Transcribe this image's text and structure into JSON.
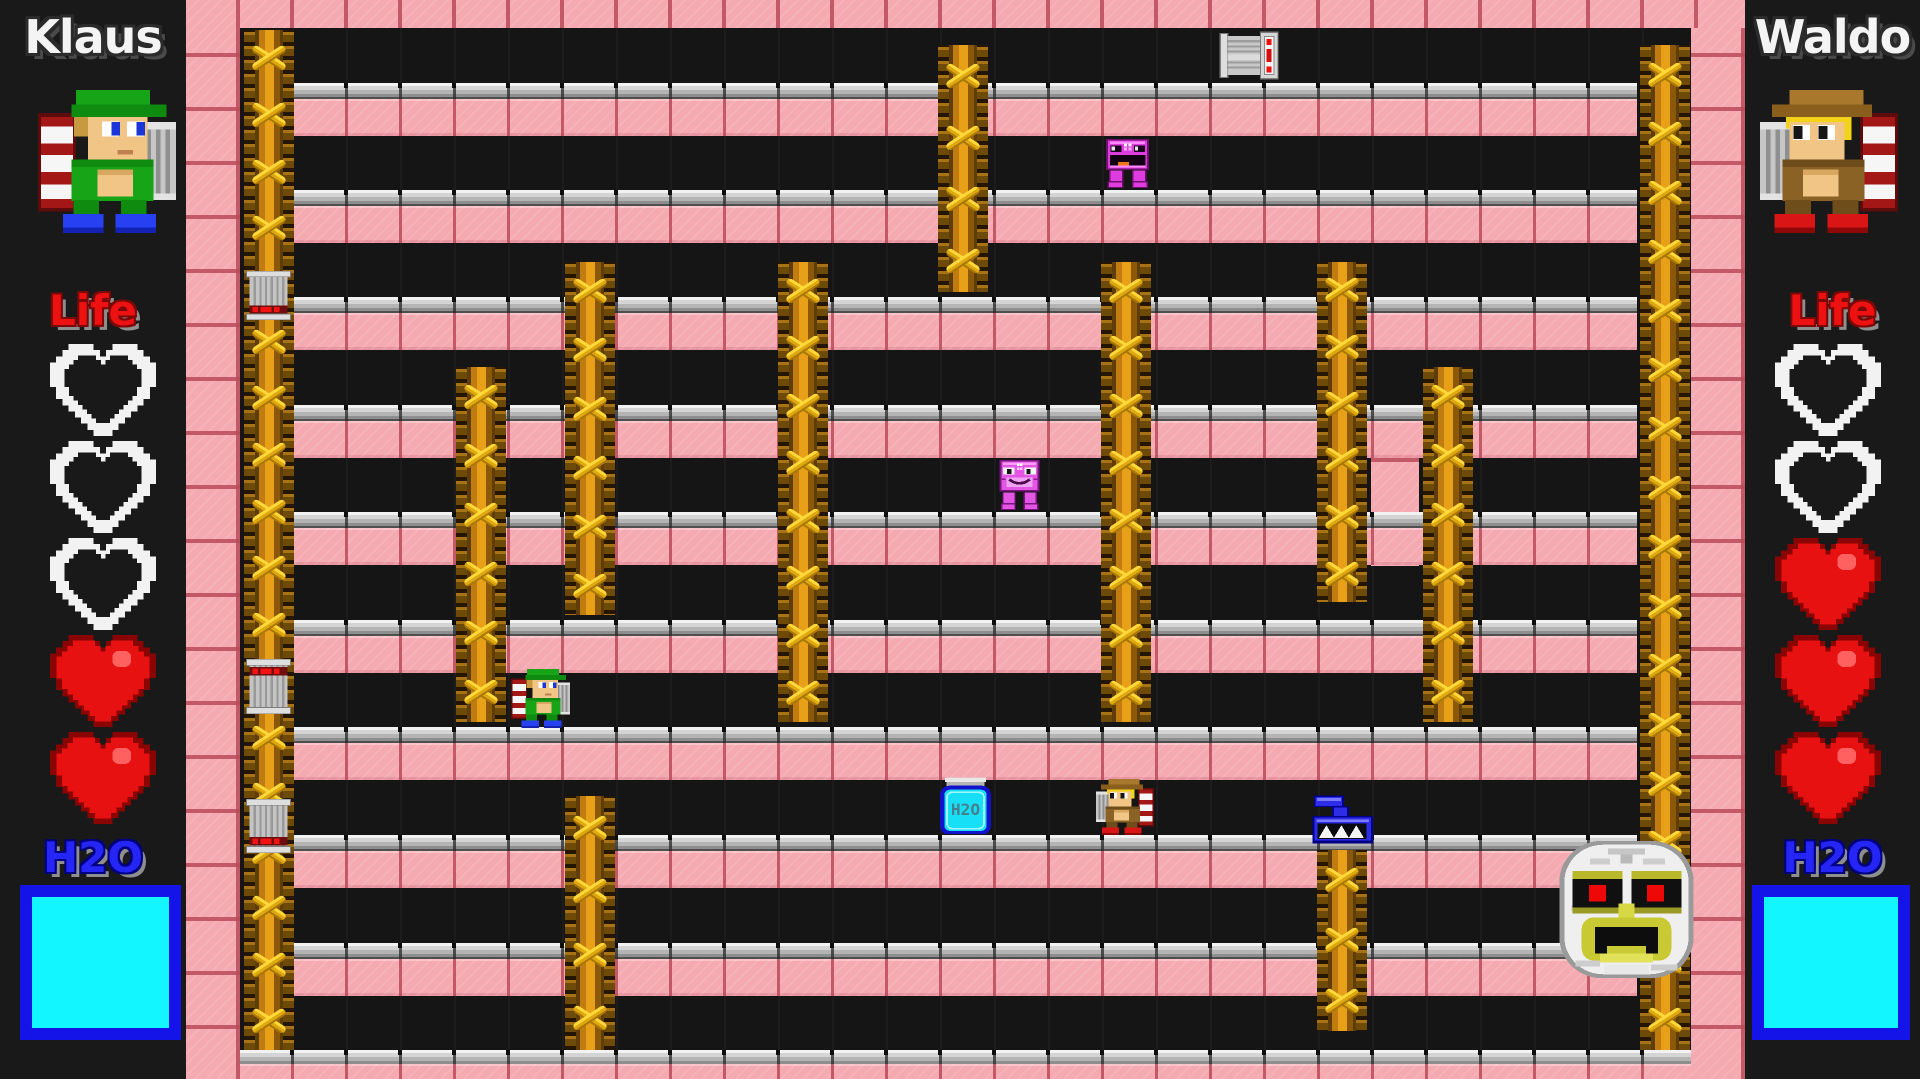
{
  "left_panel": {
    "name": "Klaus",
    "life_label": "Life",
    "h2o_label": "H2O",
    "hearts": [
      "empty",
      "empty",
      "empty",
      "full",
      "full"
    ],
    "water_percent": 100
  },
  "right_panel": {
    "name": "Waldo",
    "life_label": "Life",
    "h2o_label": "H2O",
    "hearts": [
      "empty",
      "empty",
      "full",
      "full",
      "full"
    ],
    "water_percent": 100
  },
  "items": {
    "bottle_label": "H2O"
  },
  "colors": {
    "brick": "#f5a9b1",
    "brick_seam": "#ba4a5a",
    "corridor": "#151515",
    "platform_gray": "#b4b4b4",
    "ladder_gold": "#e8a018",
    "rung_yellow": "#ffd83a",
    "heart_red": "#e81111",
    "life_red": "#ee1111",
    "h2o_blue": "#2525f5",
    "meter_border": "#1414e8",
    "water_cyan": "#12f6ff",
    "enemy_magenta": "#df3cdf",
    "tank_blue": "#2d2de8",
    "mummy_white": "#efefef"
  },
  "level": {
    "walls": [
      {
        "x": 186,
        "y": 0,
        "w": 54,
        "h": 1079
      },
      {
        "x": 1691,
        "y": 0,
        "w": 54,
        "h": 1079
      },
      {
        "x": 186,
        "y": 0,
        "w": 1559,
        "h": 28
      },
      {
        "x": 1371,
        "y": 405,
        "w": 48,
        "h": 161,
        "cap": true
      }
    ],
    "floors": [
      {
        "x": 294,
        "y": 83,
        "w": 1343
      },
      {
        "x": 294,
        "y": 190,
        "w": 1343
      },
      {
        "x": 294,
        "y": 297,
        "w": 1343
      },
      {
        "x": 294,
        "y": 405,
        "w": 1343
      },
      {
        "x": 294,
        "y": 512,
        "w": 1343
      },
      {
        "x": 294,
        "y": 620,
        "w": 1343
      },
      {
        "x": 294,
        "y": 727,
        "w": 1343
      },
      {
        "x": 294,
        "y": 835,
        "w": 1343
      },
      {
        "x": 294,
        "y": 943,
        "w": 1343
      },
      {
        "x": 240,
        "y": 1050,
        "w": 1451,
        "grayH": 14,
        "pinkH": 15
      }
    ],
    "ladders": [
      {
        "x": 244,
        "y": 30,
        "h": 1020
      },
      {
        "x": 456,
        "y": 367,
        "h": 355
      },
      {
        "x": 565,
        "y": 262,
        "h": 353
      },
      {
        "x": 565,
        "y": 796,
        "h": 254
      },
      {
        "x": 778,
        "y": 262,
        "h": 460
      },
      {
        "x": 938,
        "y": 45,
        "h": 247
      },
      {
        "x": 1101,
        "y": 262,
        "h": 460
      },
      {
        "x": 1317,
        "y": 262,
        "h": 340
      },
      {
        "x": 1317,
        "y": 850,
        "h": 181
      },
      {
        "x": 1423,
        "y": 367,
        "h": 355
      },
      {
        "x": 1640,
        "y": 45,
        "h": 1005
      }
    ],
    "sprites": [
      {
        "type": "bucket-h",
        "name": "drum-item",
        "x": 1219,
        "y": 31,
        "w": 62,
        "h": 49
      },
      {
        "type": "bucket-v",
        "variant": "bottom",
        "name": "bucket-item",
        "x": 243,
        "y": 271,
        "w": 51,
        "h": 49
      },
      {
        "type": "bucket-v",
        "variant": "top",
        "name": "bucket-item",
        "x": 243,
        "y": 659,
        "w": 51,
        "h": 55
      },
      {
        "type": "bucket-v",
        "variant": "bottom",
        "name": "bucket-item",
        "x": 243,
        "y": 799,
        "w": 51,
        "h": 54
      },
      {
        "type": "robot-mouth",
        "name": "enemy-robot-tongue",
        "x": 1098,
        "y": 133,
        "w": 59,
        "h": 58
      },
      {
        "type": "robot-cat",
        "name": "enemy-robot-cat",
        "x": 992,
        "y": 454,
        "w": 55,
        "h": 59
      },
      {
        "type": "klaus-small",
        "name": "player-klaus-field",
        "x": 511,
        "y": 669,
        "w": 59,
        "h": 59
      },
      {
        "type": "bottle",
        "name": "water-bottle-item",
        "x": 936,
        "y": 777,
        "w": 59,
        "h": 57
      },
      {
        "type": "waldo-small",
        "name": "player-waldo-field",
        "x": 1096,
        "y": 779,
        "w": 58,
        "h": 56
      },
      {
        "type": "tank",
        "name": "enemy-tank",
        "x": 1309,
        "y": 791,
        "w": 83,
        "h": 59
      },
      {
        "type": "mummy",
        "name": "mummy-boss",
        "x": 1545,
        "y": 831,
        "w": 163,
        "h": 157
      }
    ]
  }
}
